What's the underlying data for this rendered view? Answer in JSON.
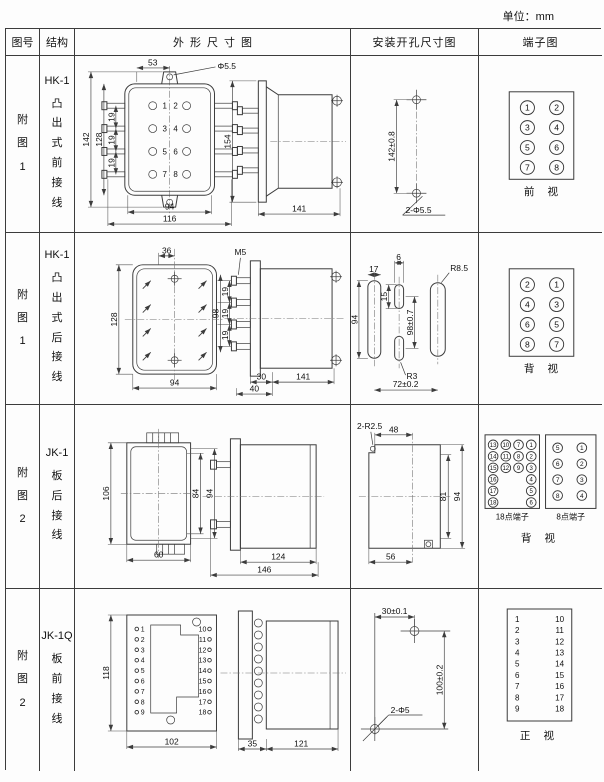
{
  "page": {
    "unit_label": "单位：mm"
  },
  "header": {
    "fig": "图号",
    "structure": "结构",
    "outline": "外形尺寸图",
    "install": "安装开孔尺寸图",
    "terminal": "端子图"
  },
  "rows": [
    {
      "fig_no": "附\n图\n1",
      "model": "HK-1",
      "wiring": "凸\n出\n式\n前\n接\n线",
      "outline": {
        "top_w": "53",
        "hole": "Φ5.5",
        "h_outer": "142",
        "h_inner": "128",
        "pitch1": "19",
        "pitch2": "19",
        "pitch3": "19",
        "bot_inner": "94",
        "bot_outer": "116",
        "terms_left": [
          "1",
          "3",
          "5",
          "7"
        ],
        "terms_right": [
          "2",
          "4",
          "6",
          "8"
        ],
        "side_h": "154",
        "side_d": "141"
      },
      "install": {
        "v_dim": "142±0.8",
        "holes": "2-Φ5.5"
      },
      "terminal": {
        "grid": [
          [
            "1",
            "2"
          ],
          [
            "3",
            "4"
          ],
          [
            "5",
            "6"
          ],
          [
            "7",
            "8"
          ]
        ],
        "caption": "前 视"
      }
    },
    {
      "fig_no": "附\n图\n1",
      "model": "HK-1",
      "wiring": "凸\n出\n式\n后\n接\n线",
      "outline": {
        "top_w": "36",
        "front_h": "128",
        "front_w": "94",
        "thread": "M5",
        "stud_h": "98",
        "pitch1": "19",
        "pitch2": "19",
        "pitch3": "19",
        "d1": "30",
        "d2": "40",
        "side_d": "141"
      },
      "install": {
        "slot_w": "17",
        "mid_w": "6",
        "r_top": "R8.5",
        "mid_h": "15",
        "slot_h": "94",
        "v_dim": "98±0.7",
        "r_bot": "R3",
        "h_dim": "72±0.2"
      },
      "terminal": {
        "grid": [
          [
            "2",
            "1"
          ],
          [
            "4",
            "3"
          ],
          [
            "6",
            "5"
          ],
          [
            "8",
            "7"
          ]
        ],
        "caption": "背 视"
      }
    },
    {
      "fig_no": "附\n图\n2",
      "model": "JK-1",
      "wiring": "板\n后\n接\n线",
      "outline": {
        "front_h": "106",
        "h_inner": "84",
        "h_outer": "94",
        "front_w": "60",
        "d_inner": "124",
        "d_outer": "146"
      },
      "install": {
        "corner_r": "2-R2.5",
        "top_w": "48",
        "h_inner": "81",
        "h_outer": "94",
        "bot_w": "56"
      },
      "terminal": {
        "grid18": [
          [
            "13",
            "10",
            "7",
            "1"
          ],
          [
            "14",
            "11",
            "8",
            "2"
          ],
          [
            "15",
            "12",
            "9",
            "3"
          ],
          [
            "16",
            "",
            "",
            "4"
          ],
          [
            "17",
            "",
            "",
            "5"
          ],
          [
            "18",
            "",
            "",
            "6"
          ]
        ],
        "label18": "18点端子",
        "grid8": [
          [
            "5",
            "1"
          ],
          [
            "6",
            "2"
          ],
          [
            "7",
            "3"
          ],
          [
            "8",
            "4"
          ]
        ],
        "label8": "8点端子",
        "caption": "背 视"
      }
    },
    {
      "fig_no": "附\n图\n2",
      "model": "JK-1Q",
      "wiring": "板\n前\n接\n线",
      "outline": {
        "front_h": "118",
        "front_w": "102",
        "terms_left": [
          "1",
          "2",
          "3",
          "4",
          "5",
          "6",
          "7",
          "8",
          "9"
        ],
        "terms_right": [
          "10",
          "11",
          "12",
          "13",
          "14",
          "15",
          "16",
          "17",
          "18"
        ],
        "d1": "35",
        "d2": "121"
      },
      "install": {
        "top_dim": "30±0.1",
        "v_dim": "100±0.2",
        "holes": "2-Φ5"
      },
      "terminal": {
        "left": [
          "1",
          "2",
          "3",
          "4",
          "5",
          "6",
          "7",
          "8",
          "9"
        ],
        "right": [
          "10",
          "11",
          "12",
          "13",
          "14",
          "15",
          "16",
          "17",
          "18"
        ],
        "caption": "正 视"
      }
    }
  ]
}
